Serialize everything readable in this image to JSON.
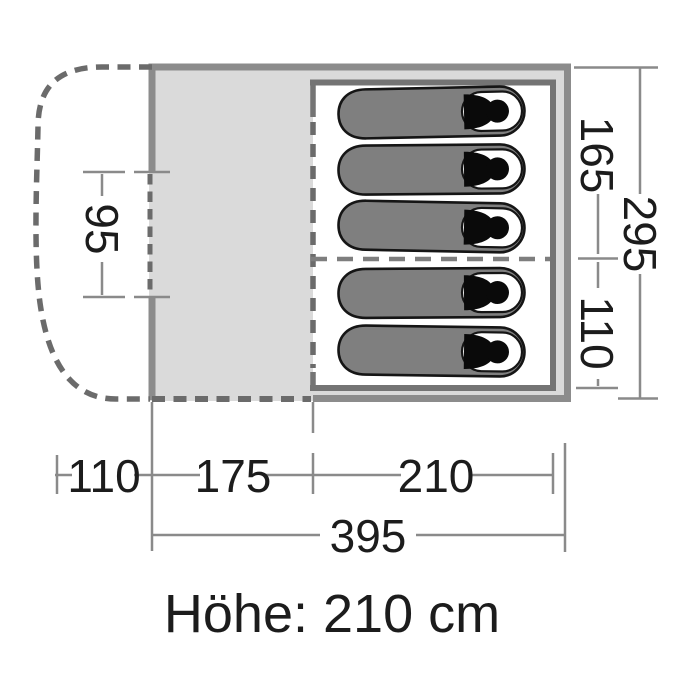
{
  "diagram": {
    "type": "tent-floorplan",
    "dimensions": {
      "door_width": "95",
      "inner_cabin_upper_depth": "165",
      "inner_cabin_lower_depth": "110",
      "total_depth": "295",
      "porch_length": "110",
      "living_area_length": "175",
      "sleeping_cabin_length": "210",
      "total_length": "395"
    },
    "height_label": "Höhe: 210 cm",
    "sleeping_bag_count": 5,
    "colors": {
      "background": "#ffffff",
      "floor_fill": "#dadada",
      "cabin_fill": "#ffffff",
      "outer_wall": "#8c8c8c",
      "inner_wall": "#747474",
      "dashed_line": "#6b6b6b",
      "dimension_line": "#8a8a8a",
      "sleeping_bag_fill": "#7f7f7f",
      "sleeping_bag_outline": "#151515",
      "figure_black": "#0a0a0a",
      "text": "#1c1c1c"
    }
  }
}
